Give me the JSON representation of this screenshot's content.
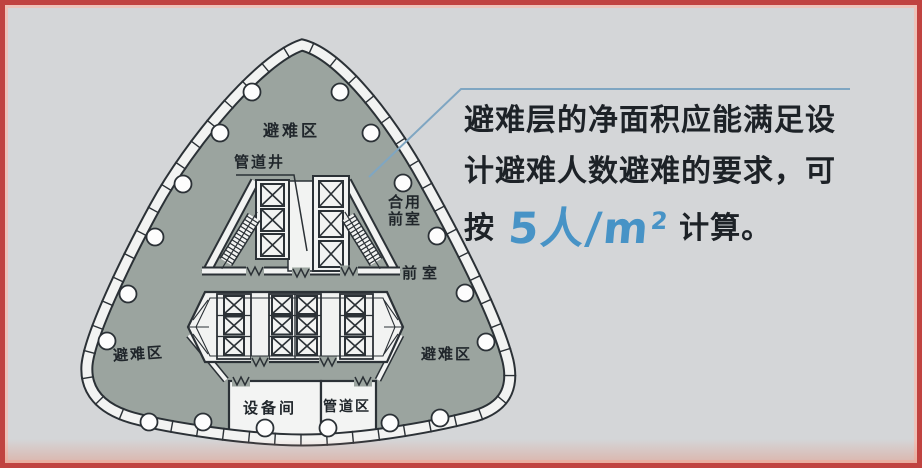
{
  "figure": {
    "background": "#D4D6D8",
    "border_color": "#C04340",
    "description_colors": {
      "floor_fill": "#9BA49F",
      "outline": "#2B3136",
      "facade_band": "#F2F3F2",
      "callout_line": "#7FA6C2",
      "highlight_blue": "#4793C6",
      "text": "#20262B"
    }
  },
  "callout": {
    "line1": "避难层的净面积应能满足设",
    "line2": "计避难人数避难的要求，可",
    "line3_prefix": "按",
    "highlight_value": "5人/m",
    "highlight_sup": "2",
    "line3_suffix": "计算。"
  },
  "plan_labels": {
    "refuge_top": "避难区",
    "refuge_left": "避难区",
    "refuge_right": "避难区",
    "pipe_shaft": "管道井",
    "shared_lobby_line1": "合用",
    "shared_lobby_line2": "前室",
    "lobby": "前室",
    "equipment_room": "设备间",
    "pipe_zone": "管道区"
  }
}
